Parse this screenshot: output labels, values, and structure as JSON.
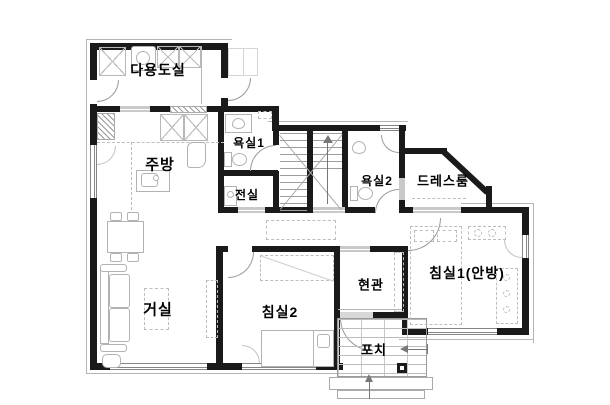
{
  "plan": {
    "type": "apartment-floor-plan",
    "rooms": [
      {
        "id": "utility-room",
        "label": "다용도실"
      },
      {
        "id": "kitchen",
        "label": "주방"
      },
      {
        "id": "bathroom-1",
        "label": "욕실1"
      },
      {
        "id": "vestibule",
        "label": "전실"
      },
      {
        "id": "bathroom-2",
        "label": "욕실2"
      },
      {
        "id": "dress-room",
        "label": "드레스룸"
      },
      {
        "id": "living-room",
        "label": "거실"
      },
      {
        "id": "bedroom-2",
        "label": "침실2"
      },
      {
        "id": "entrance",
        "label": "현관"
      },
      {
        "id": "bedroom-1",
        "label": "침실1(안방)"
      },
      {
        "id": "porch",
        "label": "포치"
      }
    ]
  }
}
